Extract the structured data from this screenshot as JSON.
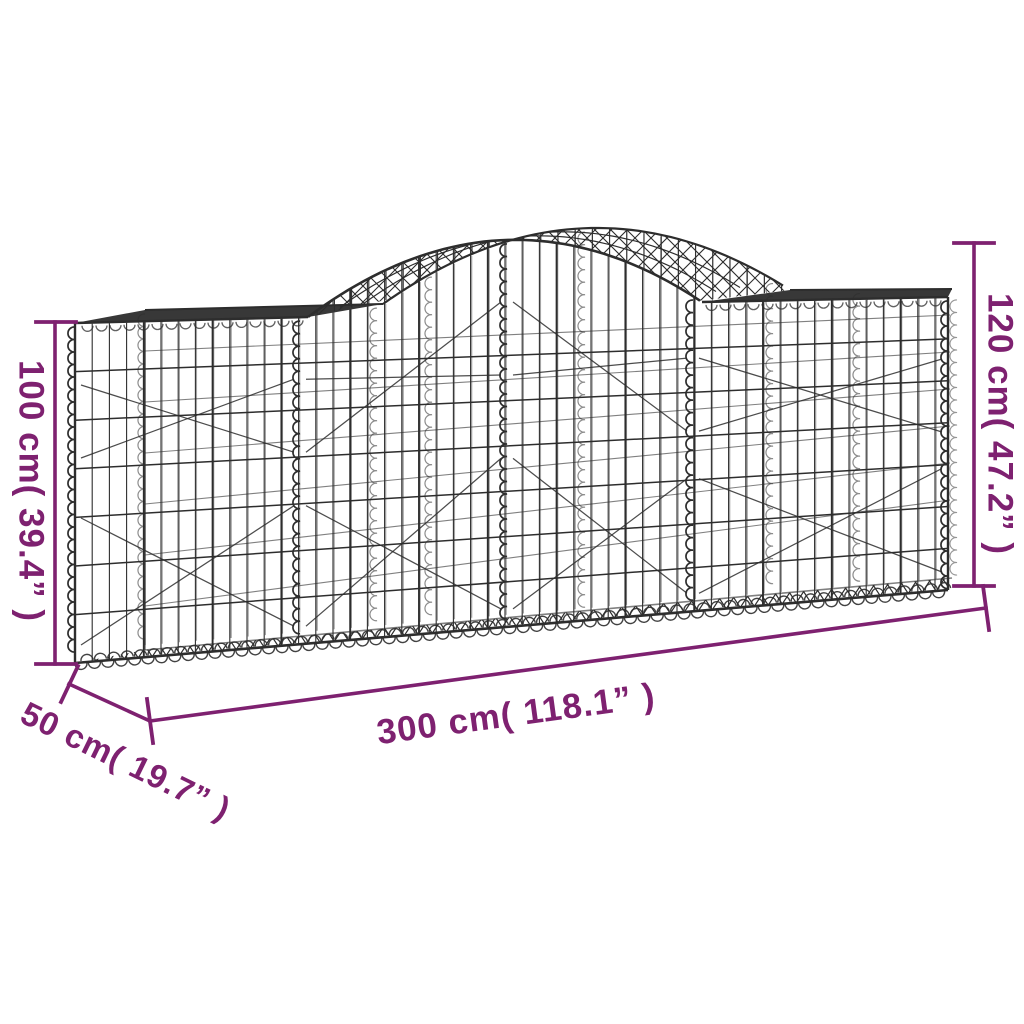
{
  "diagram": {
    "type": "product-dimension-diagram",
    "background_color": "#FFFFFF",
    "accent_color": "#7E2170",
    "wire_color": "#2D2D2D",
    "dimensions": {
      "height_left": "100 cm( 39.4” )",
      "height_right": "120 cm( 47.2” )",
      "length": "300 cm( 118.1” )",
      "depth": "50 cm( 19.7” )"
    }
  }
}
